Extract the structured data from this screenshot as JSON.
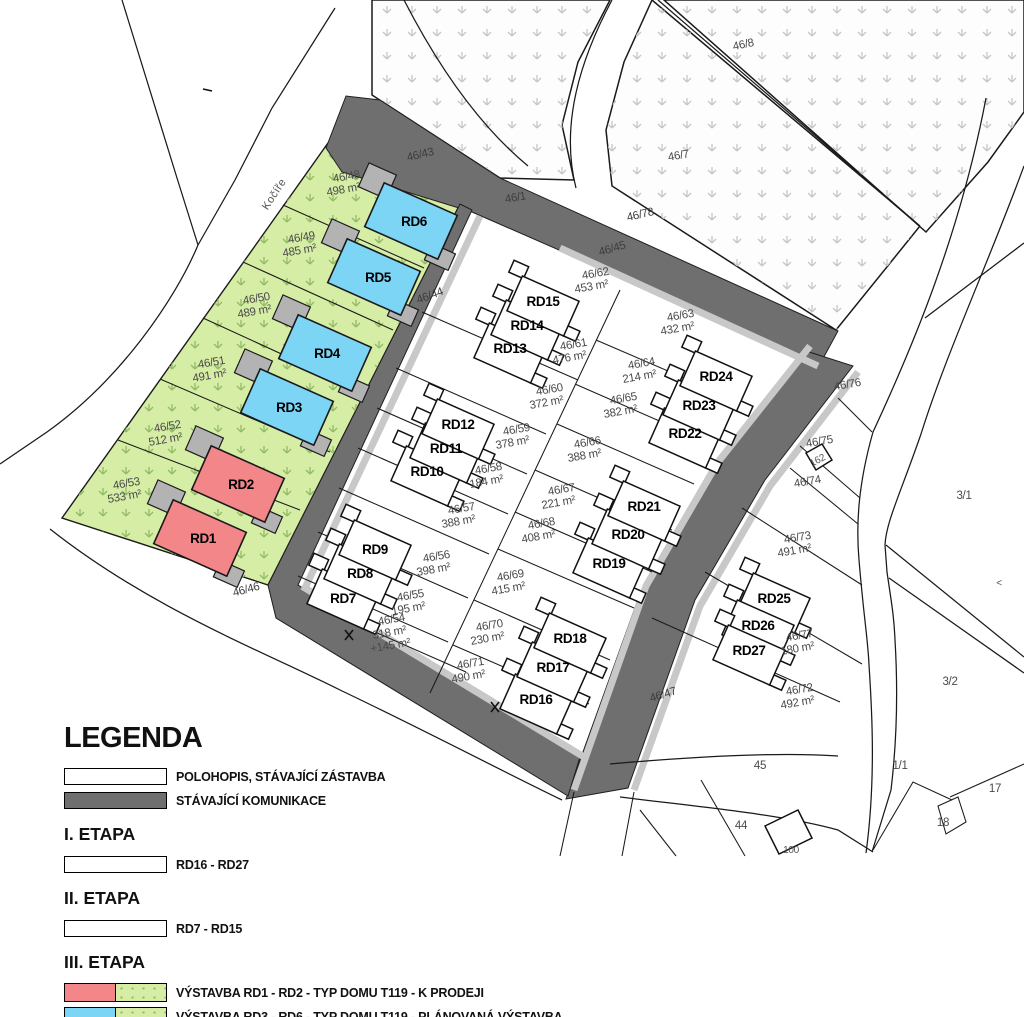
{
  "map": {
    "street_name": "Kočíře",
    "colors": {
      "road": "#6f6f6f",
      "sidewalk": "#c8c8c8",
      "green_area": "#d6eda6",
      "house_red": "#f28689",
      "house_blue": "#7dd5f5",
      "garage_gray": "#b3b3b3"
    },
    "labels": [
      {
        "t": "Kočíře",
        "x": 277,
        "y": 196,
        "r": -57,
        "c": "st"
      },
      {
        "t": "46/43",
        "x": 421,
        "y": 158,
        "r": -13,
        "c": "r"
      },
      {
        "t": "46/1",
        "x": 516,
        "y": 201,
        "r": -10,
        "c": "r"
      },
      {
        "t": "46/45",
        "x": 613,
        "y": 252,
        "r": -16,
        "c": "r"
      },
      {
        "t": "46/78",
        "x": 641,
        "y": 218,
        "r": -13,
        "c": "r"
      },
      {
        "t": "46/44",
        "x": 431,
        "y": 299,
        "r": -20,
        "c": "r"
      },
      {
        "t": "46/47",
        "x": 664,
        "y": 698,
        "r": -17,
        "c": "r"
      },
      {
        "t": "46/46",
        "x": 247,
        "y": 593,
        "r": -15,
        "c": "r"
      },
      {
        "t": "46/8",
        "x": 744,
        "y": 48,
        "r": -12,
        "c": "p"
      },
      {
        "t": "46/7",
        "x": 679,
        "y": 159,
        "r": -10,
        "c": "p"
      },
      {
        "t": "46/48",
        "x": 347,
        "y": 180,
        "r": -10,
        "c": "p"
      },
      {
        "t": "498 m²",
        "x": 344,
        "y": 193,
        "r": -10,
        "c": "p"
      },
      {
        "t": "46/49",
        "x": 302,
        "y": 241,
        "r": -10,
        "c": "p"
      },
      {
        "t": "485 m²",
        "x": 300,
        "y": 254,
        "r": -10,
        "c": "p"
      },
      {
        "t": "46/50",
        "x": 257,
        "y": 302,
        "r": -10,
        "c": "p"
      },
      {
        "t": "489 m²",
        "x": 255,
        "y": 315,
        "r": -10,
        "c": "p"
      },
      {
        "t": "46/51",
        "x": 212,
        "y": 366,
        "r": -10,
        "c": "p"
      },
      {
        "t": "491 m²",
        "x": 210,
        "y": 379,
        "r": -10,
        "c": "p"
      },
      {
        "t": "46/52",
        "x": 168,
        "y": 430,
        "r": -10,
        "c": "p"
      },
      {
        "t": "512 m²",
        "x": 166,
        "y": 443,
        "r": -10,
        "c": "p"
      },
      {
        "t": "46/53",
        "x": 127,
        "y": 487,
        "r": -10,
        "c": "p"
      },
      {
        "t": "533 m²",
        "x": 125,
        "y": 500,
        "r": -10,
        "c": "p"
      },
      {
        "t": "46/62",
        "x": 596,
        "y": 277,
        "r": -10,
        "c": "p"
      },
      {
        "t": "453 m²",
        "x": 592,
        "y": 290,
        "r": -10,
        "c": "p"
      },
      {
        "t": "46/61",
        "x": 574,
        "y": 348,
        "r": -10,
        "c": "p"
      },
      {
        "t": "476 m²",
        "x": 570,
        "y": 361,
        "r": -10,
        "c": "p"
      },
      {
        "t": "46/60",
        "x": 550,
        "y": 393,
        "r": -10,
        "c": "p"
      },
      {
        "t": "372 m²",
        "x": 547,
        "y": 406,
        "r": -10,
        "c": "p"
      },
      {
        "t": "46/59",
        "x": 517,
        "y": 433,
        "r": -10,
        "c": "p"
      },
      {
        "t": "378 m²",
        "x": 513,
        "y": 446,
        "r": -10,
        "c": "p"
      },
      {
        "t": "46/58",
        "x": 489,
        "y": 472,
        "r": -10,
        "c": "p"
      },
      {
        "t": "184 m²",
        "x": 487,
        "y": 485,
        "r": -10,
        "c": "p"
      },
      {
        "t": "46/57",
        "x": 462,
        "y": 512,
        "r": -10,
        "c": "p"
      },
      {
        "t": "388 m²",
        "x": 459,
        "y": 525,
        "r": -10,
        "c": "p"
      },
      {
        "t": "46/56",
        "x": 437,
        "y": 560,
        "r": -10,
        "c": "p"
      },
      {
        "t": "398 m²",
        "x": 434,
        "y": 573,
        "r": -10,
        "c": "p"
      },
      {
        "t": "46/55",
        "x": 411,
        "y": 599,
        "r": -10,
        "c": "p"
      },
      {
        "t": "195 m²",
        "x": 409,
        "y": 612,
        "r": -10,
        "c": "p"
      },
      {
        "t": "46/54",
        "x": 392,
        "y": 623,
        "r": -10,
        "c": "p"
      },
      {
        "t": "318 m²",
        "x": 390,
        "y": 636,
        "r": -10,
        "c": "p"
      },
      {
        "t": "+145 m²",
        "x": 391,
        "y": 649,
        "r": -10,
        "c": "p"
      },
      {
        "t": "46/63",
        "x": 681,
        "y": 319,
        "r": -10,
        "c": "p"
      },
      {
        "t": "432 m²",
        "x": 678,
        "y": 332,
        "r": -10,
        "c": "p"
      },
      {
        "t": "46/64",
        "x": 642,
        "y": 367,
        "r": -10,
        "c": "p"
      },
      {
        "t": "214 m²",
        "x": 640,
        "y": 380,
        "r": -10,
        "c": "p"
      },
      {
        "t": "46/65",
        "x": 624,
        "y": 402,
        "r": -10,
        "c": "p"
      },
      {
        "t": "382 m²",
        "x": 621,
        "y": 415,
        "r": -10,
        "c": "p"
      },
      {
        "t": "46/66",
        "x": 588,
        "y": 446,
        "r": -10,
        "c": "p"
      },
      {
        "t": "388 m²",
        "x": 585,
        "y": 459,
        "r": -10,
        "c": "p"
      },
      {
        "t": "46/67",
        "x": 562,
        "y": 493,
        "r": -10,
        "c": "p"
      },
      {
        "t": "221 m²",
        "x": 559,
        "y": 506,
        "r": -10,
        "c": "p"
      },
      {
        "t": "46/68",
        "x": 542,
        "y": 527,
        "r": -10,
        "c": "p"
      },
      {
        "t": "408 m²",
        "x": 539,
        "y": 540,
        "r": -10,
        "c": "p"
      },
      {
        "t": "46/69",
        "x": 511,
        "y": 579,
        "r": -10,
        "c": "p"
      },
      {
        "t": "415 m²",
        "x": 509,
        "y": 592,
        "r": -10,
        "c": "p"
      },
      {
        "t": "46/70",
        "x": 490,
        "y": 629,
        "r": -10,
        "c": "p"
      },
      {
        "t": "230 m²",
        "x": 488,
        "y": 642,
        "r": -10,
        "c": "p"
      },
      {
        "t": "46/71",
        "x": 471,
        "y": 667,
        "r": -10,
        "c": "p"
      },
      {
        "t": "490 m²",
        "x": 469,
        "y": 680,
        "r": -10,
        "c": "p"
      },
      {
        "t": "46/76",
        "x": 848,
        "y": 388,
        "r": -10,
        "c": "p"
      },
      {
        "t": "46/75",
        "x": 820,
        "y": 445,
        "r": -10,
        "c": "p"
      },
      {
        "t": "162",
        "x": 819,
        "y": 463,
        "r": -28,
        "c": "s"
      },
      {
        "t": "46/74",
        "x": 808,
        "y": 485,
        "r": -10,
        "c": "p"
      },
      {
        "t": "46/73",
        "x": 798,
        "y": 541,
        "r": -10,
        "c": "p"
      },
      {
        "t": "491 m²",
        "x": 795,
        "y": 554,
        "r": -10,
        "c": "p"
      },
      {
        "t": "46/77",
        "x": 800,
        "y": 639,
        "r": -10,
        "c": "p"
      },
      {
        "t": "180 m²",
        "x": 798,
        "y": 652,
        "r": -10,
        "c": "p"
      },
      {
        "t": "46/72",
        "x": 800,
        "y": 693,
        "r": -10,
        "c": "p"
      },
      {
        "t": "492 m²",
        "x": 798,
        "y": 706,
        "r": -10,
        "c": "p"
      },
      {
        "t": "3/1",
        "x": 964,
        "y": 499,
        "r": 0,
        "c": "p"
      },
      {
        "t": "3/2",
        "x": 950,
        "y": 685,
        "r": 0,
        "c": "p"
      },
      {
        "t": "1/1",
        "x": 900,
        "y": 769,
        "r": 0,
        "c": "p"
      },
      {
        "t": "17",
        "x": 995,
        "y": 792,
        "r": 0,
        "c": "p"
      },
      {
        "t": "18",
        "x": 943,
        "y": 826,
        "r": 0,
        "c": "p"
      },
      {
        "t": "45",
        "x": 760,
        "y": 769,
        "r": 0,
        "c": "p"
      },
      {
        "t": "44",
        "x": 741,
        "y": 829,
        "r": 0,
        "c": "p"
      },
      {
        "t": "100",
        "x": 791,
        "y": 853,
        "r": 0,
        "c": "s"
      },
      {
        "t": "<",
        "x": 999,
        "y": 586,
        "r": 0,
        "c": "s"
      },
      {
        "t": "RD1",
        "x": 203,
        "y": 543,
        "r": 0,
        "c": "rd"
      },
      {
        "t": "RD2",
        "x": 241,
        "y": 489,
        "r": 0,
        "c": "rd"
      },
      {
        "t": "RD3",
        "x": 289,
        "y": 412,
        "r": 0,
        "c": "rd"
      },
      {
        "t": "RD4",
        "x": 327,
        "y": 358,
        "r": 0,
        "c": "rd"
      },
      {
        "t": "RD5",
        "x": 378,
        "y": 282,
        "r": 0,
        "c": "rd"
      },
      {
        "t": "RD6",
        "x": 414,
        "y": 226,
        "r": 0,
        "c": "rd"
      },
      {
        "t": "RD7",
        "x": 343,
        "y": 603,
        "r": 0,
        "c": "rd"
      },
      {
        "t": "RD8",
        "x": 360,
        "y": 578,
        "r": 0,
        "c": "rd"
      },
      {
        "t": "RD9",
        "x": 375,
        "y": 554,
        "r": 0,
        "c": "rd"
      },
      {
        "t": "RD10",
        "x": 427,
        "y": 476,
        "r": 0,
        "c": "rd"
      },
      {
        "t": "RD11",
        "x": 446,
        "y": 453,
        "r": 0,
        "c": "rd"
      },
      {
        "t": "RD12",
        "x": 458,
        "y": 429,
        "r": 0,
        "c": "rd"
      },
      {
        "t": "RD13",
        "x": 510,
        "y": 353,
        "r": 0,
        "c": "rd"
      },
      {
        "t": "RD14",
        "x": 527,
        "y": 330,
        "r": 0,
        "c": "rd"
      },
      {
        "t": "RD15",
        "x": 543,
        "y": 306,
        "r": 0,
        "c": "rd"
      },
      {
        "t": "RD16",
        "x": 536,
        "y": 704,
        "r": 0,
        "c": "rd"
      },
      {
        "t": "RD17",
        "x": 553,
        "y": 672,
        "r": 0,
        "c": "rd"
      },
      {
        "t": "RD18",
        "x": 570,
        "y": 643,
        "r": 0,
        "c": "rd"
      },
      {
        "t": "RD19",
        "x": 609,
        "y": 568,
        "r": 0,
        "c": "rd"
      },
      {
        "t": "RD20",
        "x": 628,
        "y": 539,
        "r": 0,
        "c": "rd"
      },
      {
        "t": "RD21",
        "x": 644,
        "y": 511,
        "r": 0,
        "c": "rd"
      },
      {
        "t": "RD22",
        "x": 685,
        "y": 438,
        "r": 0,
        "c": "rd"
      },
      {
        "t": "RD23",
        "x": 699,
        "y": 410,
        "r": 0,
        "c": "rd"
      },
      {
        "t": "RD24",
        "x": 716,
        "y": 381,
        "r": 0,
        "c": "rd"
      },
      {
        "t": "RD25",
        "x": 774,
        "y": 603,
        "r": 0,
        "c": "rd"
      },
      {
        "t": "RD26",
        "x": 758,
        "y": 630,
        "r": 0,
        "c": "rd"
      },
      {
        "t": "RD27",
        "x": 749,
        "y": 655,
        "r": 0,
        "c": "rd"
      }
    ]
  },
  "legend": {
    "title": "LEGENDA",
    "rows": [
      {
        "swatch": "white",
        "label": "POLOHOPIS, STÁVAJÍCÍ ZÁSTAVBA"
      },
      {
        "swatch": "road",
        "label": "STÁVAJÍCÍ KOMUNIKACE"
      }
    ],
    "etapa1": {
      "heading": "I. ETAPA",
      "swatch": "white",
      "label": "RD16 - RD27"
    },
    "etapa2": {
      "heading": "II. ETAPA",
      "swatch": "white",
      "label": "RD7 - RD15"
    },
    "etapa3": {
      "heading": "III. ETAPA",
      "items": [
        {
          "swatch": "red-green",
          "label": "VÝSTAVBA RD1 - RD2 - TYP DOMU T119 - K PRODEJI"
        },
        {
          "swatch": "blue-green",
          "label": "VÝSTAVBA RD3 - RD6 - TYP DOMU T119 - PLÁNOVANÁ VÝSTAVBA"
        }
      ]
    }
  }
}
